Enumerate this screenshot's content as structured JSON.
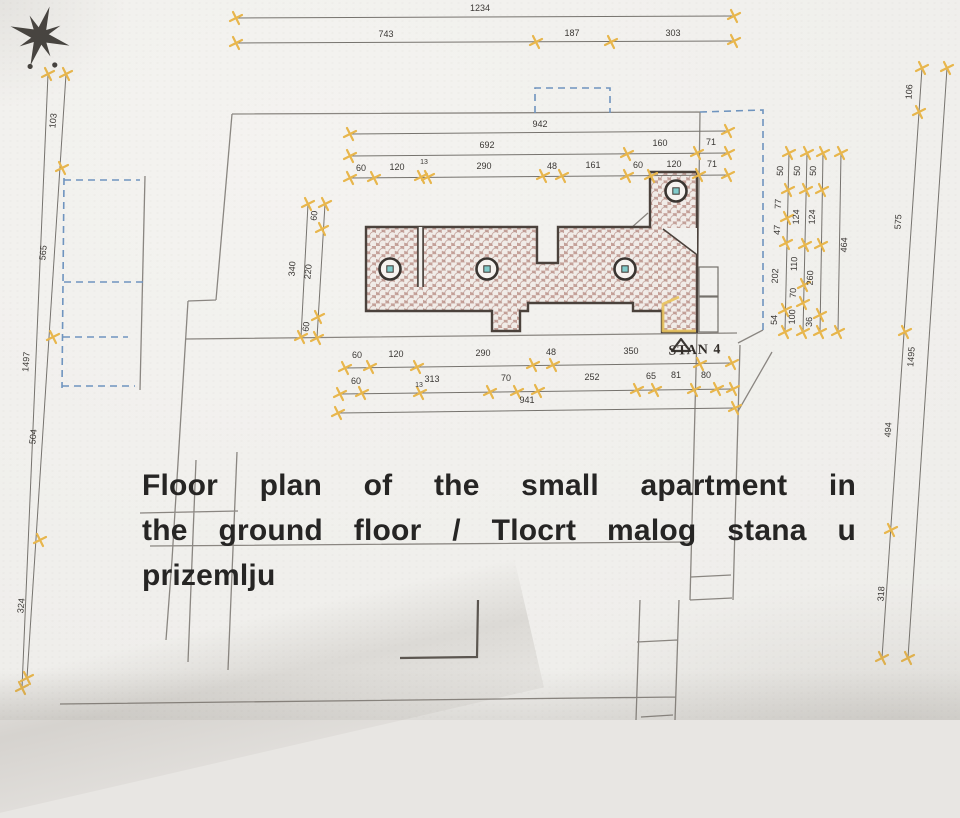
{
  "caption": {
    "full_text": "Floor plan of the small apartment in the ground floor / Tlocrt malog stana u prizemlju",
    "lines": [
      "Floor plan of the small apartment in",
      "the ground floor / Tlocrt malog stana u",
      "prizemlju"
    ]
  },
  "apartment_label": "STAN 4",
  "icons": {
    "north_arrow": "eight-point-compass-star",
    "entrance_marker": "open-triangle",
    "dimension_tick": "yellow-cross-sparkle"
  },
  "colors": {
    "paper": "#f1f0ed",
    "tick_yellow": "#e8b64c",
    "tile_ground": "#c5a29a",
    "tile_dot": "#f1ece8",
    "column_teal": "#82cbcb",
    "dashed_blue": "#6f94bf",
    "outline_dark": "#4b423c",
    "site_gray": "#8a8681",
    "highlight_yellow": "#e9c35c"
  },
  "dimensions": {
    "lines": [
      [
        236,
        18,
        734,
        16
      ],
      [
        236,
        43,
        734,
        41
      ],
      [
        48,
        74,
        22,
        688
      ],
      [
        66,
        74,
        27,
        678
      ],
      [
        947,
        68,
        908,
        658
      ],
      [
        922,
        68,
        882,
        658
      ],
      [
        350,
        134,
        728,
        131
      ],
      [
        350,
        156,
        728,
        153
      ],
      [
        350,
        178,
        728,
        175
      ],
      [
        308,
        204,
        301,
        337
      ],
      [
        325,
        204,
        317,
        338
      ],
      [
        789,
        153,
        785,
        332
      ],
      [
        807,
        153,
        803,
        332
      ],
      [
        823,
        153,
        820,
        332
      ],
      [
        841,
        153,
        838,
        332
      ],
      [
        345,
        368,
        732,
        363
      ],
      [
        340,
        394,
        733,
        389
      ],
      [
        338,
        413,
        735,
        408
      ]
    ],
    "ticks": [
      [
        236,
        18
      ],
      [
        734,
        16
      ],
      [
        236,
        43
      ],
      [
        536,
        42
      ],
      [
        611,
        42
      ],
      [
        734,
        41
      ],
      [
        48,
        74
      ],
      [
        22,
        688
      ],
      [
        66,
        74
      ],
      [
        62,
        168
      ],
      [
        53,
        337
      ],
      [
        40,
        540
      ],
      [
        27,
        678
      ],
      [
        947,
        68
      ],
      [
        908,
        658
      ],
      [
        922,
        68
      ],
      [
        919,
        112
      ],
      [
        905,
        332
      ],
      [
        891,
        530
      ],
      [
        882,
        658
      ],
      [
        350,
        134
      ],
      [
        728,
        131
      ],
      [
        350,
        156
      ],
      [
        627,
        154
      ],
      [
        697,
        153
      ],
      [
        728,
        153
      ],
      [
        350,
        178
      ],
      [
        374,
        178
      ],
      [
        421,
        177
      ],
      [
        428,
        177
      ],
      [
        543,
        176
      ],
      [
        562,
        176
      ],
      [
        627,
        176
      ],
      [
        651,
        176
      ],
      [
        699,
        175
      ],
      [
        728,
        175
      ],
      [
        308,
        204
      ],
      [
        301,
        337
      ],
      [
        325,
        204
      ],
      [
        322,
        229
      ],
      [
        318,
        317
      ],
      [
        317,
        338
      ],
      [
        789,
        153
      ],
      [
        788,
        190
      ],
      [
        787,
        218
      ],
      [
        786,
        243
      ],
      [
        785,
        310
      ],
      [
        785,
        332
      ],
      [
        807,
        153
      ],
      [
        806,
        190
      ],
      [
        805,
        245
      ],
      [
        804,
        285
      ],
      [
        803,
        303
      ],
      [
        803,
        332
      ],
      [
        823,
        153
      ],
      [
        822,
        190
      ],
      [
        821,
        245
      ],
      [
        820,
        315
      ],
      [
        820,
        332
      ],
      [
        841,
        153
      ],
      [
        838,
        332
      ],
      [
        345,
        368
      ],
      [
        370,
        367
      ],
      [
        417,
        367
      ],
      [
        533,
        365
      ],
      [
        553,
        365
      ],
      [
        700,
        364
      ],
      [
        732,
        363
      ],
      [
        340,
        394
      ],
      [
        362,
        393
      ],
      [
        420,
        393
      ],
      [
        490,
        392
      ],
      [
        517,
        392
      ],
      [
        538,
        391
      ],
      [
        637,
        390
      ],
      [
        655,
        390
      ],
      [
        694,
        390
      ],
      [
        717,
        389
      ],
      [
        733,
        389
      ],
      [
        338,
        413
      ],
      [
        735,
        408
      ]
    ],
    "labels": [
      {
        "t": "1234",
        "x": 480,
        "y": 11
      },
      {
        "t": "743",
        "x": 386,
        "y": 37
      },
      {
        "t": "187",
        "x": 572,
        "y": 36
      },
      {
        "t": "303",
        "x": 673,
        "y": 36
      },
      {
        "t": "103",
        "x": 56,
        "y": 121,
        "r": -84
      },
      {
        "t": "565",
        "x": 46,
        "y": 253,
        "r": -84
      },
      {
        "t": "1497",
        "x": 29,
        "y": 362,
        "r": -86
      },
      {
        "t": "504",
        "x": 36,
        "y": 437,
        "r": -84
      },
      {
        "t": "324",
        "x": 24,
        "y": 606,
        "r": -84
      },
      {
        "t": "106",
        "x": 912,
        "y": 92,
        "r": -86
      },
      {
        "t": "575",
        "x": 901,
        "y": 222,
        "r": -86
      },
      {
        "t": "1495",
        "x": 914,
        "y": 357,
        "r": -86
      },
      {
        "t": "494",
        "x": 891,
        "y": 430,
        "r": -86
      },
      {
        "t": "318",
        "x": 884,
        "y": 594,
        "r": -86
      },
      {
        "t": "942",
        "x": 540,
        "y": 127
      },
      {
        "t": "692",
        "x": 487,
        "y": 148
      },
      {
        "t": "160",
        "x": 660,
        "y": 146
      },
      {
        "t": "71",
        "x": 711,
        "y": 145
      },
      {
        "t": "60",
        "x": 361,
        "y": 171
      },
      {
        "t": "120",
        "x": 397,
        "y": 170
      },
      {
        "t": "13",
        "x": 424,
        "y": 164,
        "s": 7
      },
      {
        "t": "290",
        "x": 484,
        "y": 169
      },
      {
        "t": "48",
        "x": 552,
        "y": 169
      },
      {
        "t": "161",
        "x": 593,
        "y": 168
      },
      {
        "t": "60",
        "x": 638,
        "y": 168
      },
      {
        "t": "120",
        "x": 674,
        "y": 167
      },
      {
        "t": "71",
        "x": 712,
        "y": 167
      },
      {
        "t": "340",
        "x": 295,
        "y": 269,
        "r": -86
      },
      {
        "t": "60",
        "x": 317,
        "y": 216,
        "r": -84
      },
      {
        "t": "220",
        "x": 311,
        "y": 272,
        "r": -84
      },
      {
        "t": "60",
        "x": 309,
        "y": 327,
        "r": -84
      },
      {
        "t": "50",
        "x": 783,
        "y": 171,
        "r": -88
      },
      {
        "t": "77",
        "x": 781,
        "y": 204,
        "r": -88
      },
      {
        "t": "47",
        "x": 780,
        "y": 230,
        "r": -88
      },
      {
        "t": "202",
        "x": 778,
        "y": 276,
        "r": -88
      },
      {
        "t": "54",
        "x": 777,
        "y": 320,
        "r": -88
      },
      {
        "t": "50",
        "x": 800,
        "y": 171,
        "r": -88
      },
      {
        "t": "124",
        "x": 799,
        "y": 217,
        "r": -88
      },
      {
        "t": "110",
        "x": 797,
        "y": 264,
        "r": -88
      },
      {
        "t": "70",
        "x": 796,
        "y": 293,
        "r": -88
      },
      {
        "t": "100",
        "x": 795,
        "y": 317,
        "r": -88
      },
      {
        "t": "50",
        "x": 816,
        "y": 171,
        "r": -88
      },
      {
        "t": "124",
        "x": 815,
        "y": 217,
        "r": -88
      },
      {
        "t": "260",
        "x": 813,
        "y": 278,
        "r": -88
      },
      {
        "t": "36",
        "x": 812,
        "y": 322,
        "r": -88
      },
      {
        "t": "464",
        "x": 847,
        "y": 245,
        "r": -88
      },
      {
        "t": "60",
        "x": 357,
        "y": 358
      },
      {
        "t": "120",
        "x": 396,
        "y": 357
      },
      {
        "t": "290",
        "x": 483,
        "y": 356
      },
      {
        "t": "48",
        "x": 551,
        "y": 355
      },
      {
        "t": "350",
        "x": 631,
        "y": 354
      },
      {
        "t": "60",
        "x": 356,
        "y": 384
      },
      {
        "t": "13",
        "x": 419,
        "y": 387,
        "s": 7
      },
      {
        "t": "313",
        "x": 432,
        "y": 382
      },
      {
        "t": "70",
        "x": 506,
        "y": 381
      },
      {
        "t": "252",
        "x": 592,
        "y": 380
      },
      {
        "t": "65",
        "x": 651,
        "y": 379
      },
      {
        "t": "81",
        "x": 676,
        "y": 378
      },
      {
        "t": "80",
        "x": 706,
        "y": 378
      },
      {
        "t": "941",
        "x": 527,
        "y": 403
      }
    ]
  }
}
